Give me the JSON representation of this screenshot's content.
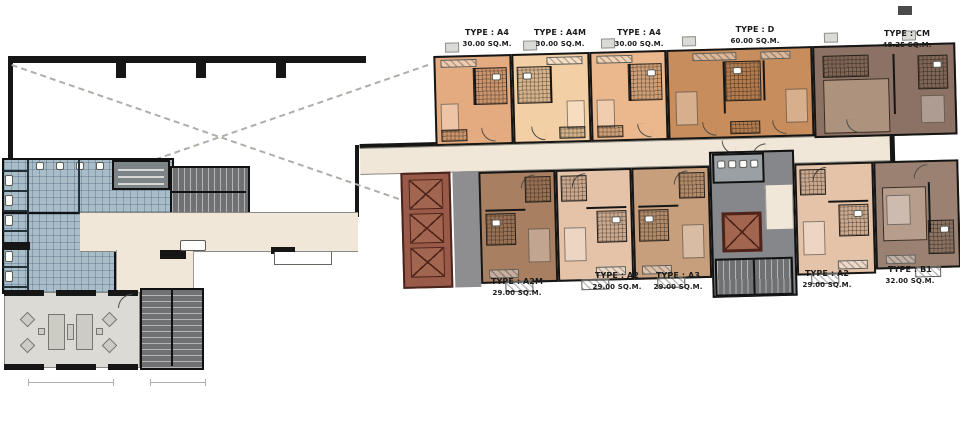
{
  "plan": {
    "units_top": [
      {
        "type": "TYPE : A4",
        "area": "30.00 SQ.M."
      },
      {
        "type": "TYPE : A4M",
        "area": "30.00 SQ.M."
      },
      {
        "type": "TYPE : A4",
        "area": "30.00 SQ.M."
      },
      {
        "type": "TYPE : D",
        "area": "60.00 SQ.M."
      },
      {
        "type": "TYPE : CM",
        "area": "48.25 SQ.M."
      }
    ],
    "units_bottom": [
      {
        "type": "TYPE : A2M",
        "area": "29.00 SQ.M."
      },
      {
        "type": "TYPE : A2",
        "area": "29.00 SQ.M."
      },
      {
        "type": "TYPE : A3",
        "area": "29.00 SQ.M."
      },
      {
        "type": "TYPE : A2",
        "area": "29.00 SQ.M."
      },
      {
        "type": "TYPE : B1",
        "area": "32.00 SQ.M."
      }
    ],
    "colors": {
      "corridor": "#f0e7d9",
      "amenity_tile": "#a9bdc9",
      "stair_gray": "#6f7173",
      "elevator_maroon": "#9a5a49",
      "lobby_gray": "#8e8e90",
      "unit_a4": "#e5ab80",
      "unit_a4m": "#f2cfa4",
      "unit_a4_2": "#eab88c",
      "unit_d": "#c78d5c",
      "unit_cm": "#8b7264",
      "unit_a2m": "#a87f61",
      "unit_a2": "#e4c3a9",
      "unit_a3": "#c89f7d",
      "unit_b1": "#9a8172",
      "lounge_floor": "#dbdad4"
    }
  }
}
